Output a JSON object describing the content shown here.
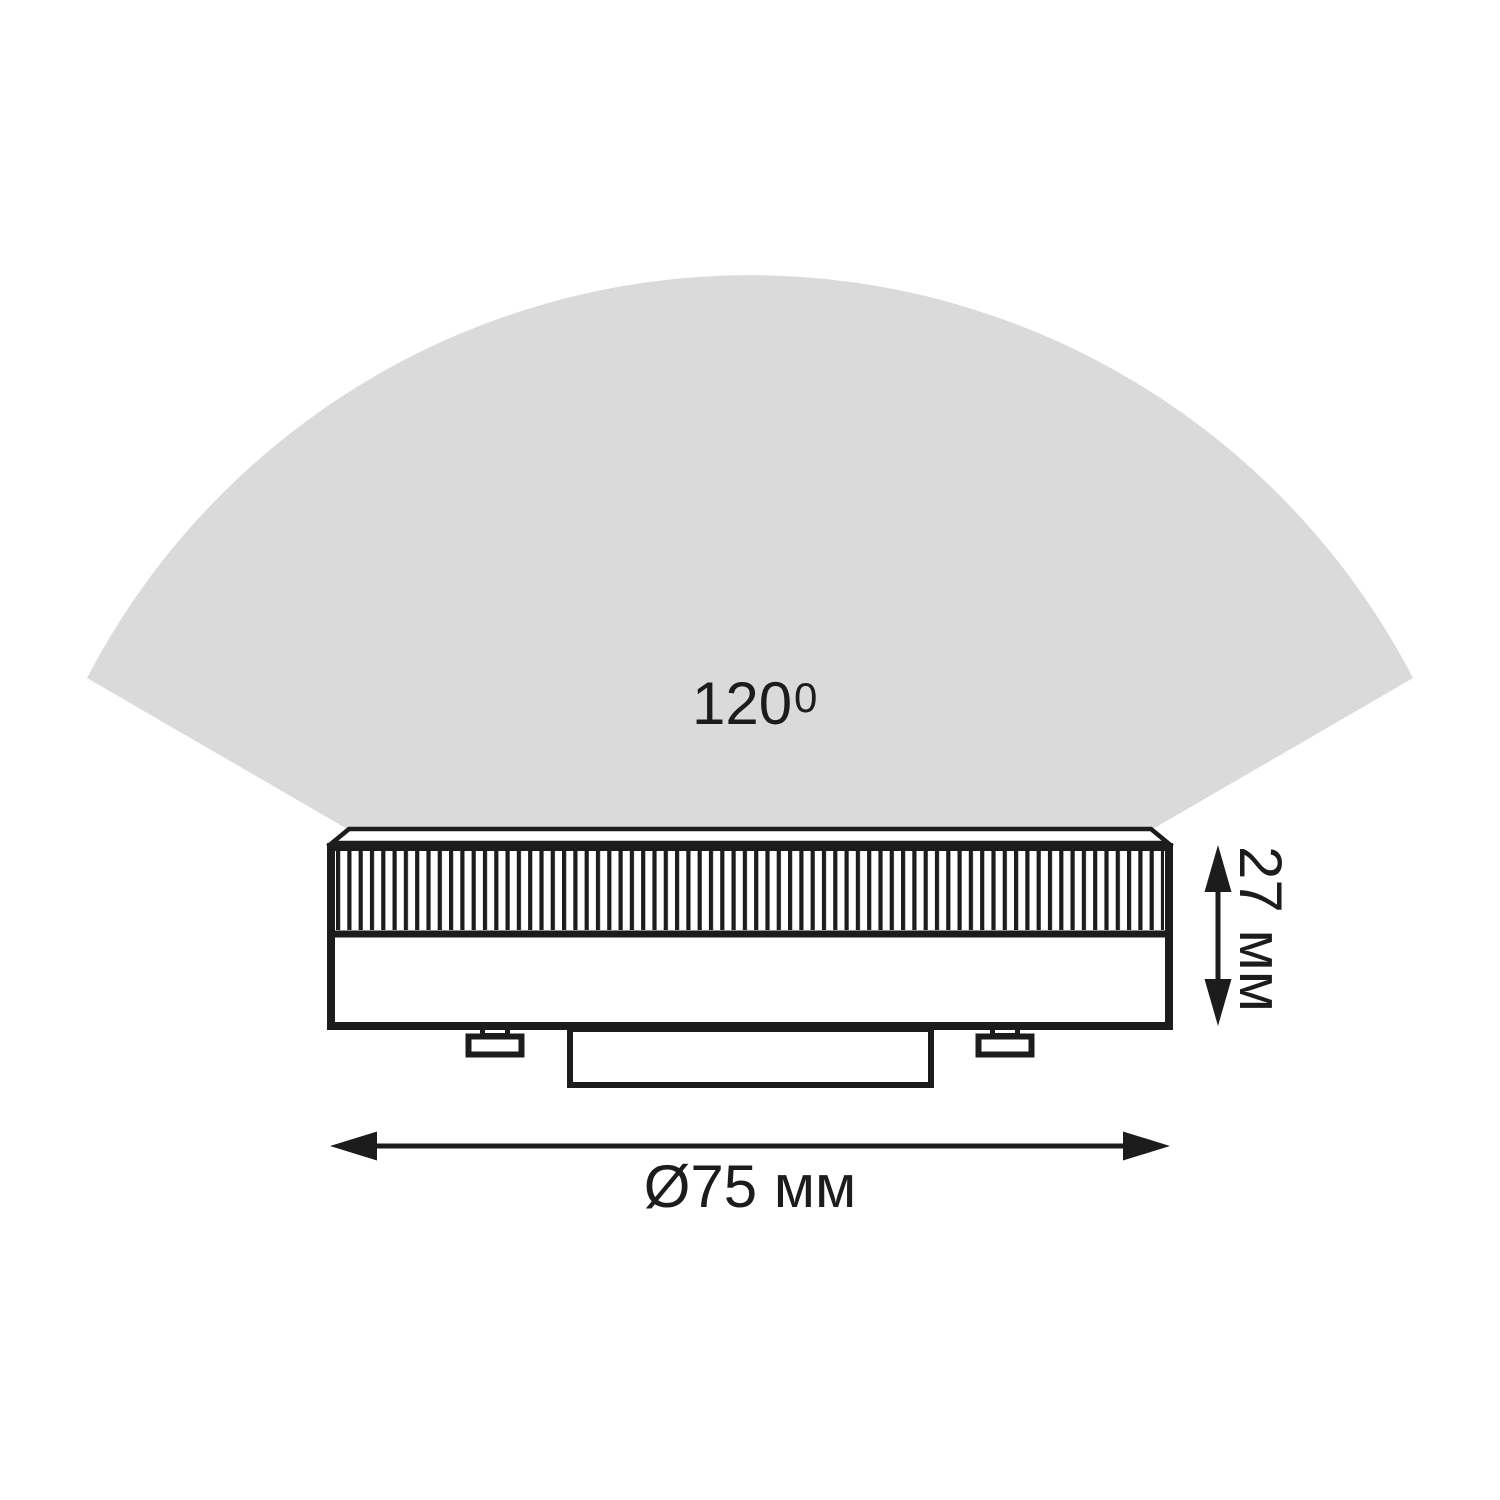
{
  "diagram": {
    "beam": {
      "angle_value": "120",
      "angle_superscript": "0"
    },
    "dimensions": {
      "diameter_label": "Ø75 мм",
      "height_label": "27 мм"
    },
    "colors": {
      "beam_fill": "#dadada",
      "line": "#1c1c1c",
      "background": "#ffffff"
    },
    "icons": {
      "diameter_arrow": "horizontal-double-arrow-icon",
      "height_arrow": "vertical-double-arrow-icon"
    }
  }
}
